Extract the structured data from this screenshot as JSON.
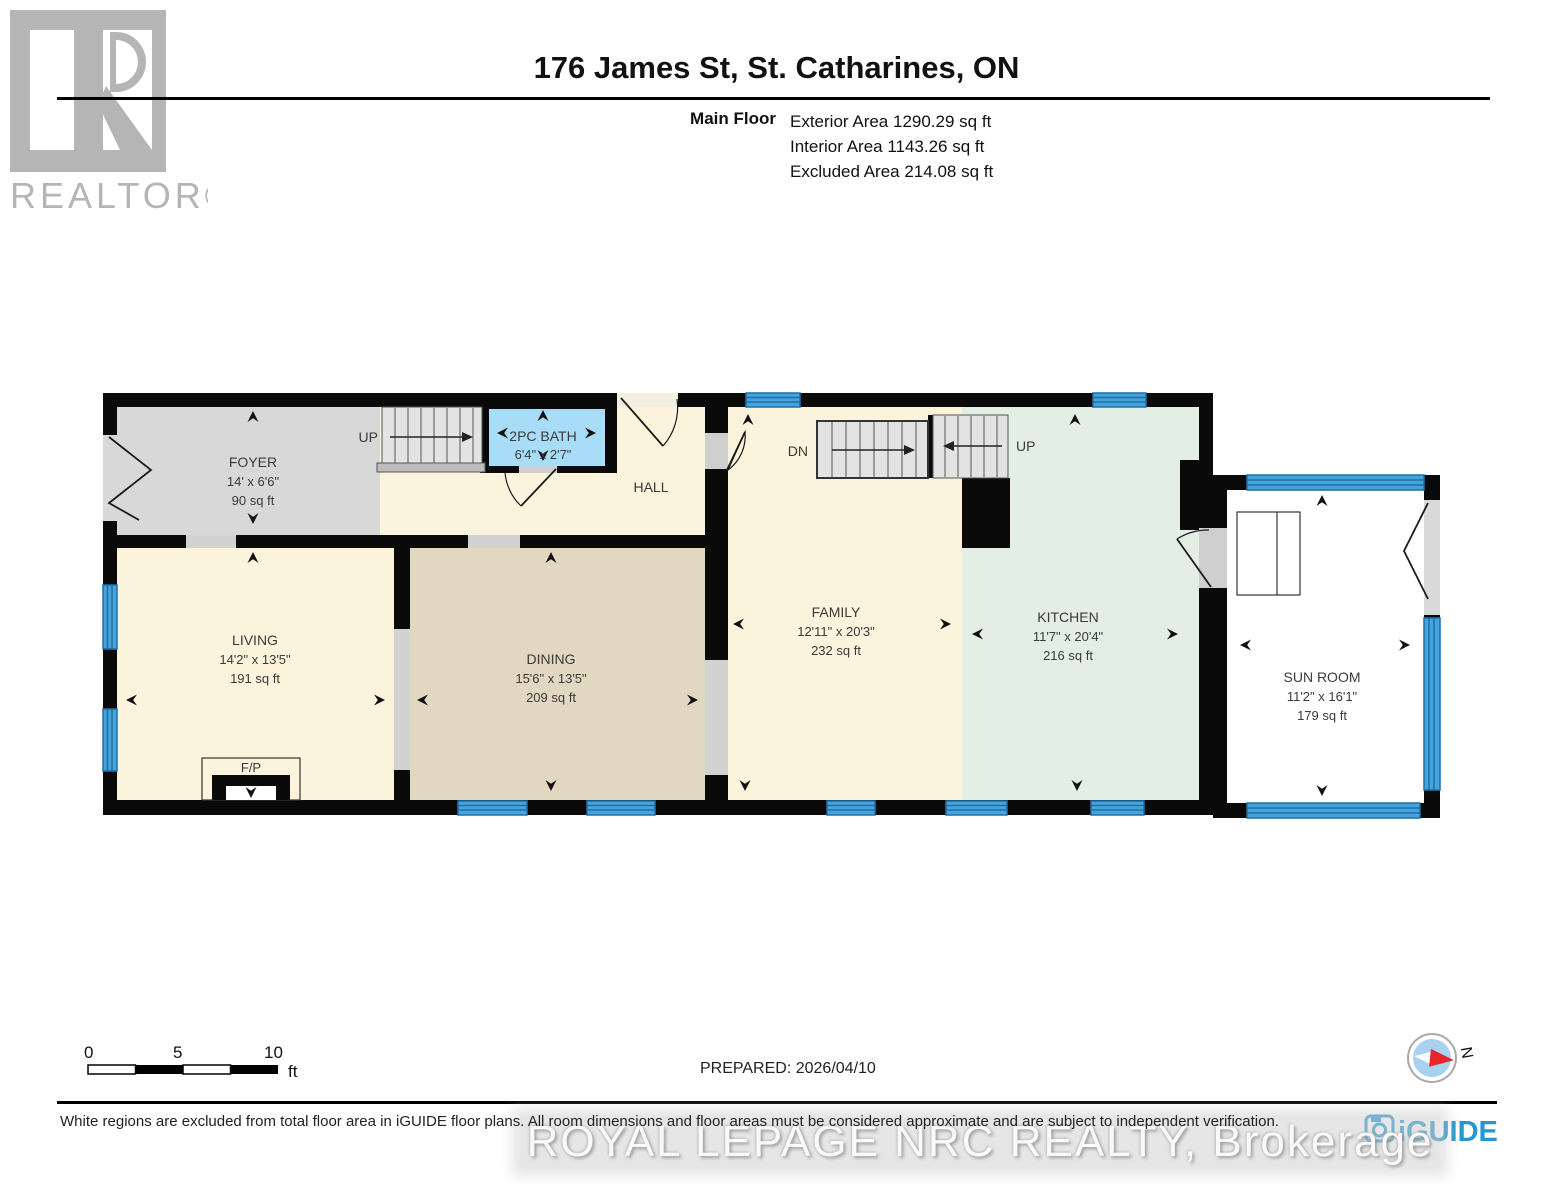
{
  "header": {
    "title": "176 James St, St. Catharines, ON",
    "floor_label": "Main Floor",
    "exterior_area": "Exterior Area 1290.29 sq ft",
    "interior_area": "Interior Area 1143.26 sq ft",
    "excluded_area": "Excluded Area 214.08 sq ft",
    "realtor_logo_text": "REALTOR®"
  },
  "rooms": {
    "foyer": {
      "name": "FOYER",
      "dims": "14' x 6'6\"",
      "area": "90 sq ft"
    },
    "bath": {
      "name": "2PC BATH",
      "dims": "6'4\" x 2'7\""
    },
    "hall": {
      "name": "HALL"
    },
    "living": {
      "name": "LIVING",
      "dims": "14'2\" x 13'5\"",
      "area": "191 sq ft"
    },
    "dining": {
      "name": "DINING",
      "dims": "15'6\" x 13'5\"",
      "area": "209 sq ft"
    },
    "family": {
      "name": "FAMILY",
      "dims": "12'11\" x 20'3\"",
      "area": "232 sq ft"
    },
    "kitchen": {
      "name": "KITCHEN",
      "dims": "11'7\" x 20'4\"",
      "area": "216 sq ft"
    },
    "sunroom": {
      "name": "SUN ROOM",
      "dims": "11'2\" x 16'1\"",
      "area": "179 sq ft"
    }
  },
  "plan_labels": {
    "stairs_up_foyer": "UP",
    "stairs_dn_family": "DN",
    "stairs_up_kitchen": "UP",
    "fireplace": "F/P"
  },
  "scale_bar": {
    "tick0": "0",
    "tick5": "5",
    "tick10": "10",
    "unit": "ft"
  },
  "footer": {
    "prepared": "PREPARED: 2026/04/10",
    "compass_n": "N",
    "disclaimer": "White regions are excluded from total floor area in iGUIDE floor plans. All room dimensions and floor areas must be considered approximate and are subject to independent verification.",
    "watermark": "ROYAL LEPAGE NRC REALTY, Brokerage",
    "brand": "iGUIDE"
  },
  "colors": {
    "wall": "#0a0a0a",
    "cream_room": "#FBF3DB",
    "foyer_gray": "#D8D8D8",
    "dining_tan": "#E2D7C0",
    "kitchen_mint": "#E3EEE5",
    "bath_blue": "#A9DCF7",
    "window_blue": "#45A4DC",
    "iguide_blue": "#2598CE",
    "compass_red": "#E8262A"
  }
}
